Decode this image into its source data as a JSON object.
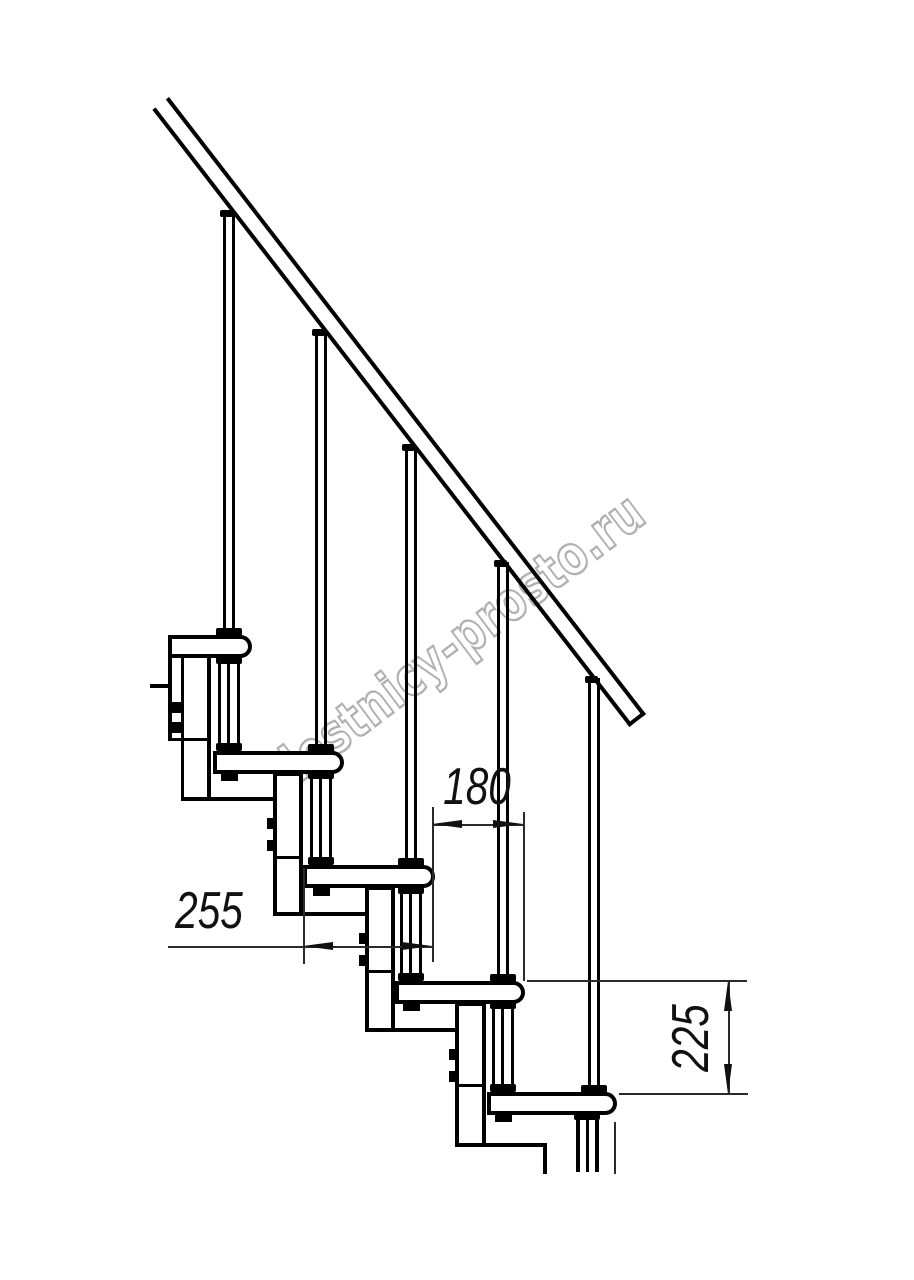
{
  "drawing": {
    "tread_count": 5,
    "baluster_count": 5
  },
  "dimensions": {
    "step_run": {
      "value": "180"
    },
    "tread_depth": {
      "value": "255"
    },
    "step_rise": {
      "value": "225"
    }
  },
  "watermark": {
    "text": "lestnicy-prosto.ru",
    "outline_color": "#b0b0b0"
  },
  "colors": {
    "line": "#000000",
    "thin_line": "#2a2a2a",
    "background": "#ffffff"
  }
}
